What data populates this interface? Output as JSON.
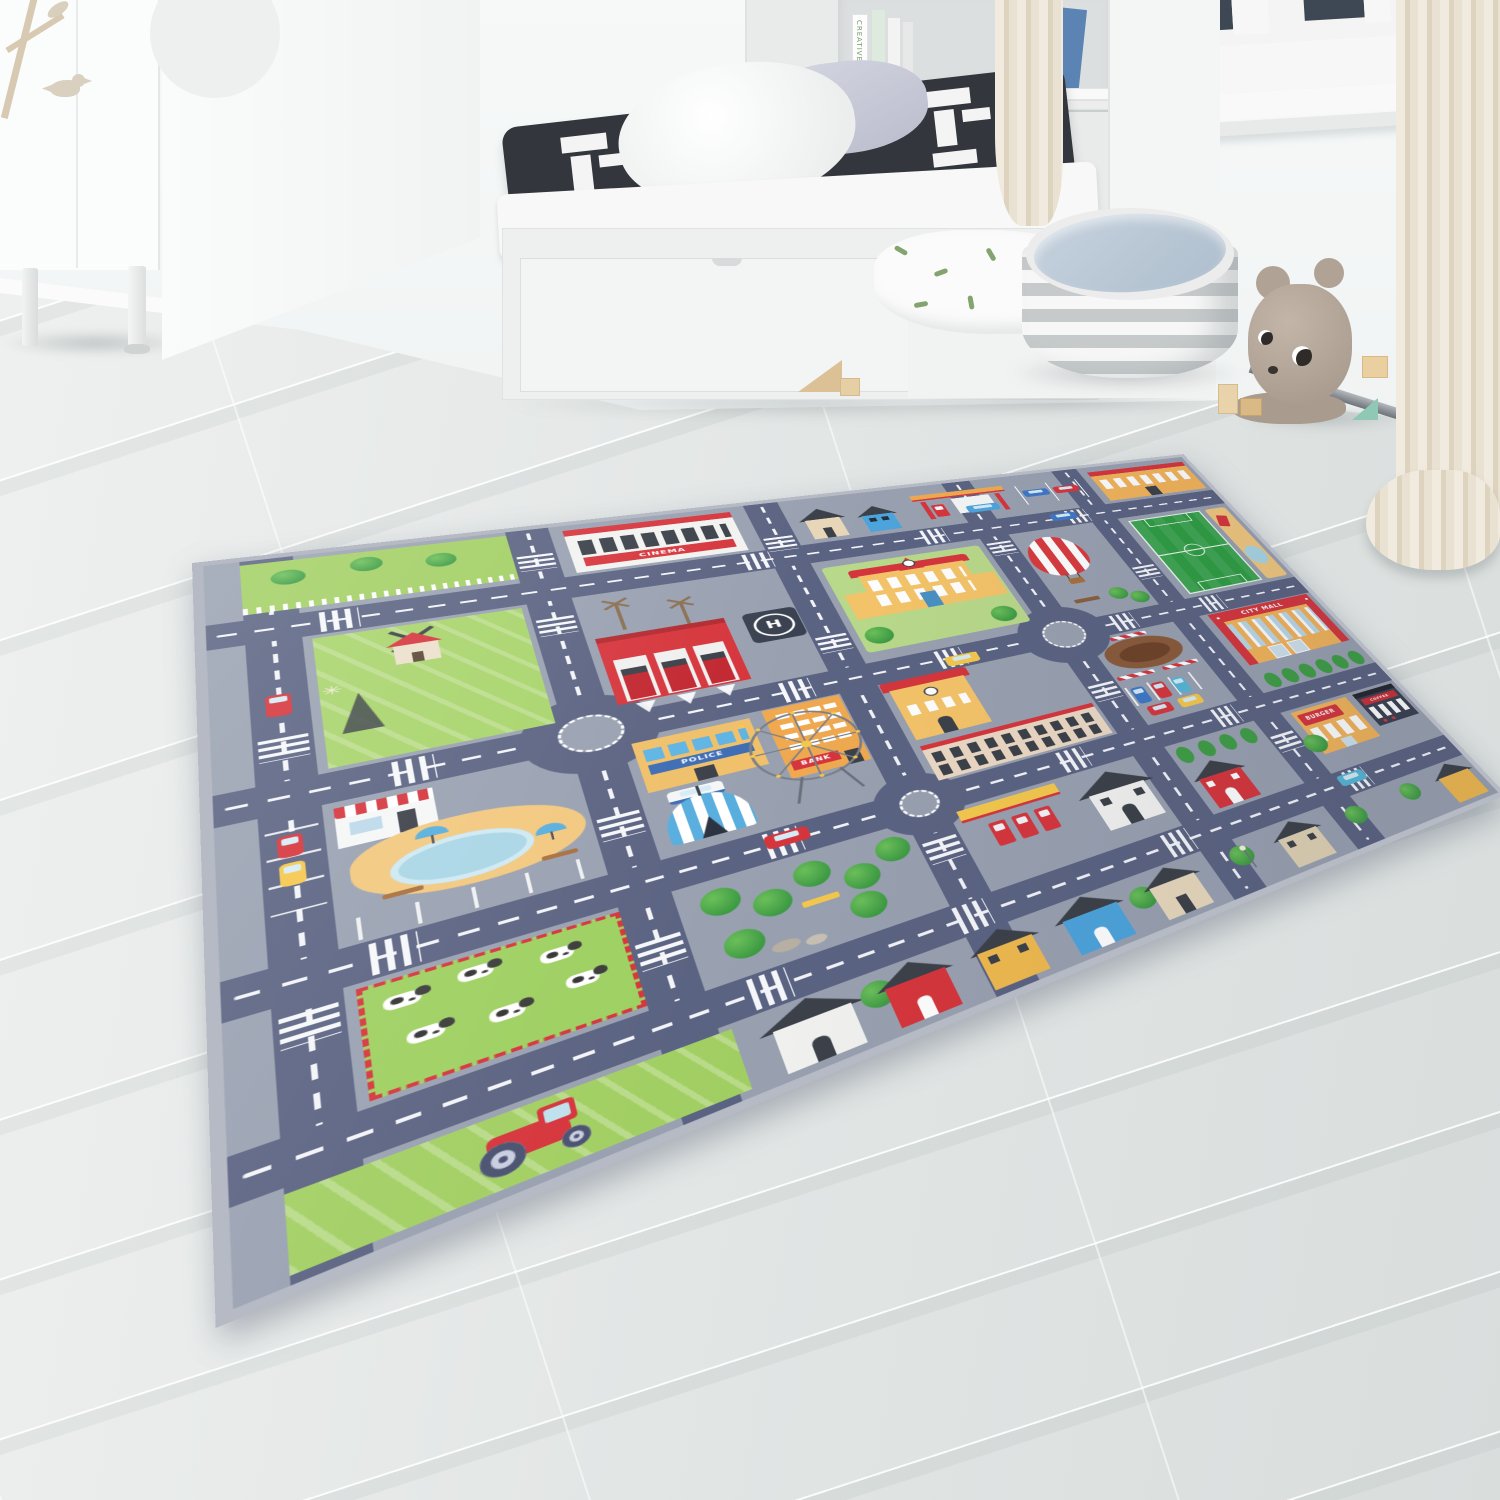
{
  "rug": {
    "signs": {
      "cinema": "CINEMA",
      "police": "POLICE",
      "bank": "BANK",
      "city_mall": "CITY MALL",
      "burger": "BURGER",
      "coffee": "COFFEE",
      "helipad": "H"
    },
    "colors": {
      "base_gray": "#99a1b1",
      "road": "#5b6382",
      "binding": "#b6bac4",
      "grass": "#a2cf63",
      "accent_red": "#d6353c",
      "accent_orange": "#f3b45a",
      "accent_yellow": "#f5c469",
      "water": "#aad6e6"
    }
  },
  "room": {
    "book_spine": "CREATIVE",
    "colors": {
      "wall": "#f4f6f6",
      "floor": "#e3e7e6",
      "curtain": "#e9e2d2",
      "pouf_top": "#b6c5d4",
      "plush": "#b4a79a"
    }
  }
}
